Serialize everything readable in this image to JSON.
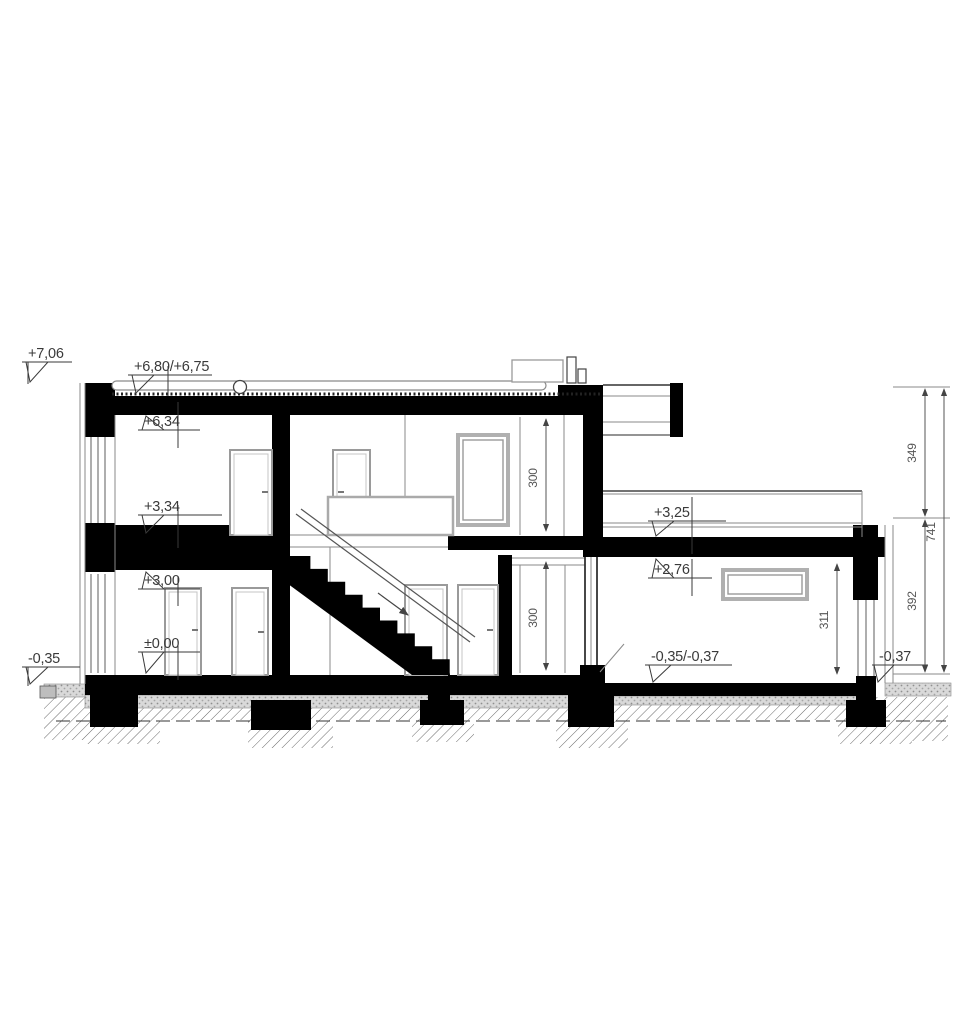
{
  "drawing": {
    "type": "architectural-cross-section",
    "levels": [
      {
        "name": "roof-attic-top",
        "value": "+7,06"
      },
      {
        "name": "flat-roof-surface",
        "value": "+6,80/+6,75"
      },
      {
        "name": "upper-ceiling",
        "value": "+6,34"
      },
      {
        "name": "upper-floor-finish",
        "value": "+3,34"
      },
      {
        "name": "ground-ceiling",
        "value": "+3,00"
      },
      {
        "name": "ground-floor-finish",
        "value": "±0,00"
      },
      {
        "name": "terrace-grade-left",
        "value": "-0,35"
      },
      {
        "name": "garage-roof-top",
        "value": "+3,25"
      },
      {
        "name": "garage-ceiling",
        "value": "+2,76"
      },
      {
        "name": "garage-floor",
        "value": "-0,35/-0,37"
      },
      {
        "name": "grade-right",
        "value": "-0,37"
      }
    ],
    "dimensions": [
      {
        "name": "upper-storey-height",
        "value": "300"
      },
      {
        "name": "ground-storey-height",
        "value": "300"
      },
      {
        "name": "garage-clear-height",
        "value": "311"
      },
      {
        "name": "right-chain-upper",
        "value": "349"
      },
      {
        "name": "right-chain-lower",
        "value": "392"
      },
      {
        "name": "right-chain-total",
        "value": "741"
      }
    ],
    "colors": {
      "section_fill": "#000000",
      "text": "#3a3a3a",
      "frame_gray": "#9a9a9a",
      "layer_gray": "#d9d9d9"
    }
  }
}
